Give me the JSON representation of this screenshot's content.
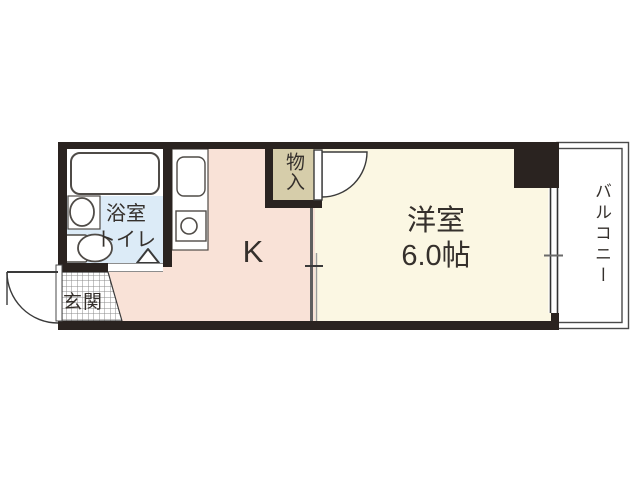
{
  "plan": {
    "colors": {
      "wall": "#2a2320",
      "kitchen_floor": "#f9e2d7",
      "room_floor": "#fbf7e3",
      "bathroom_floor": "#dcebf7",
      "storage_floor": "#d6cdaa"
    },
    "rooms": {
      "bathroom": {
        "line1": "浴室",
        "line2": "トイレ"
      },
      "entrance": {
        "label": "玄関"
      },
      "kitchen": {
        "label": "K"
      },
      "storage": {
        "label": "物入"
      },
      "western_room": {
        "name": "洋室",
        "size": "6.0帖"
      },
      "balcony": {
        "label": "バルコニー"
      }
    }
  }
}
